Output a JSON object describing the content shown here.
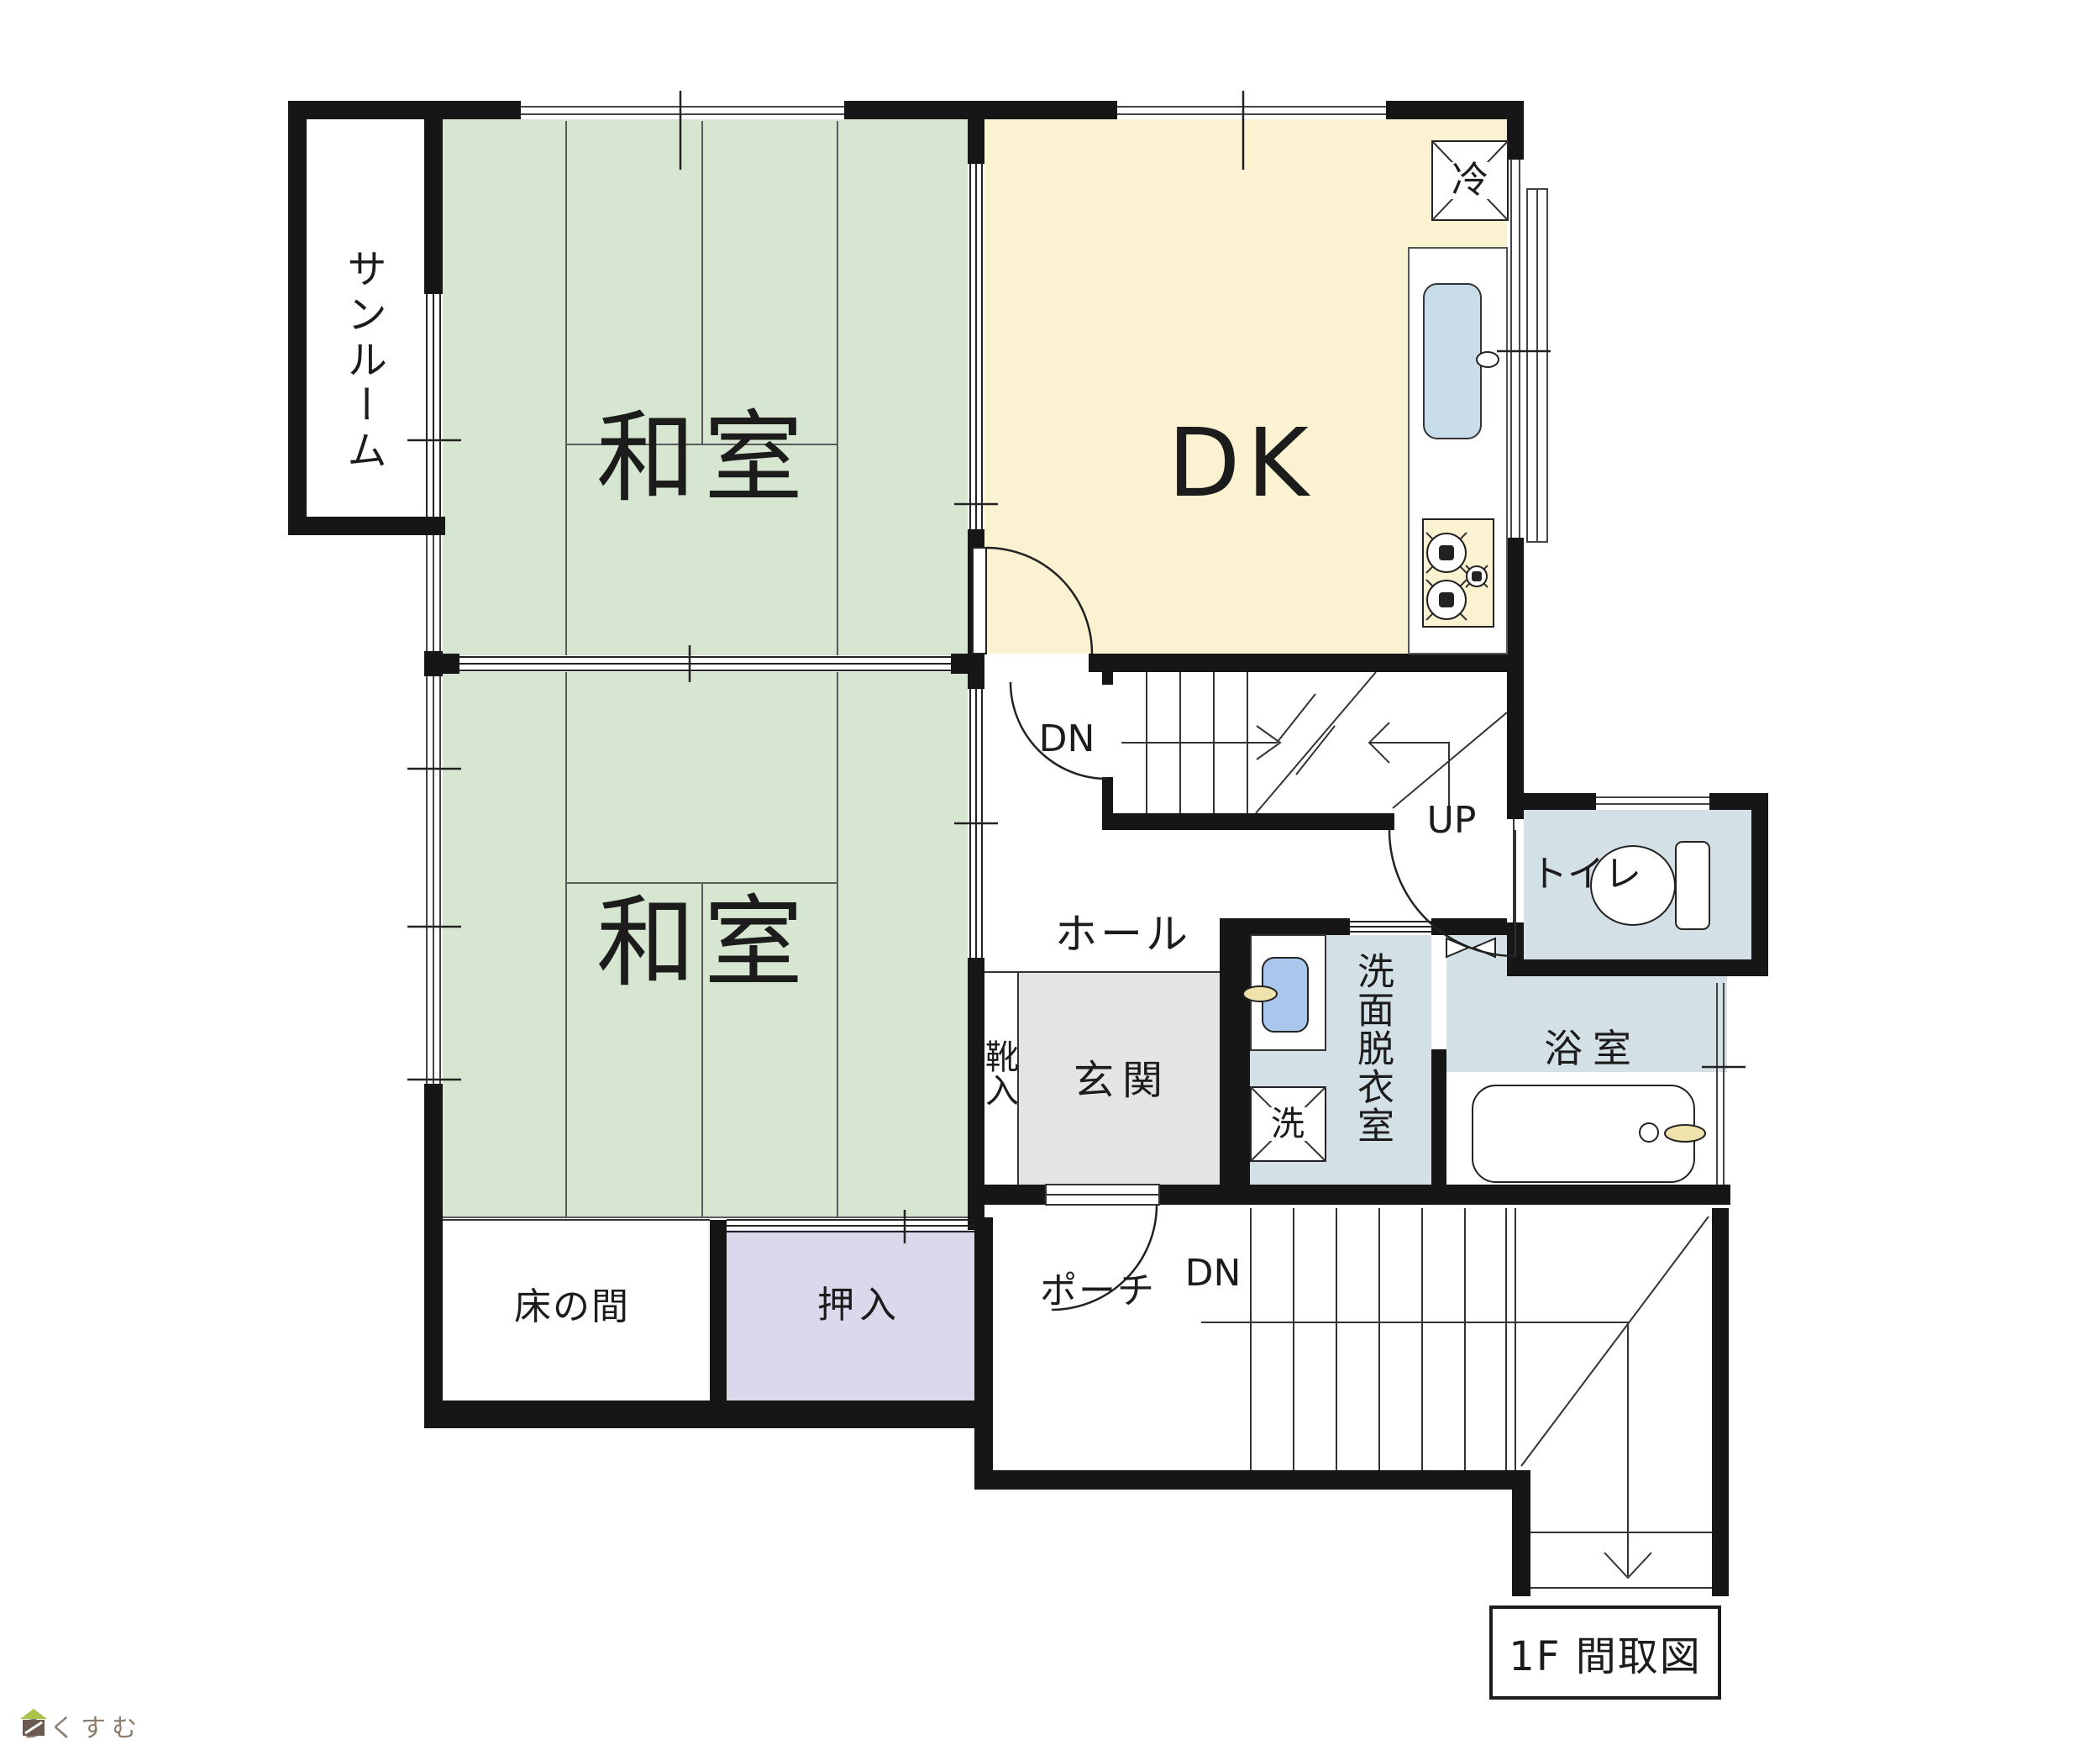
{
  "labels": {
    "sunroom": "サンルーム",
    "washitsu_upper": "和室",
    "washitsu_lower": "和室",
    "dk": "DK",
    "fridge": "冷",
    "hall": "ホール",
    "stairs_dn": "DN",
    "stairs_up": "UP",
    "toilet": "トイレ",
    "bath": "浴室",
    "washroom": "洗面脱衣室",
    "washer": "洗",
    "genkan": "玄関",
    "shoe_cabinet": "靴入",
    "tokonoma": "床の間",
    "oshiire": "押入",
    "porch": "ポーチ",
    "porch_dn": "DN",
    "plan_caption": "1F 間取図",
    "watermark": "らくすむ"
  },
  "colors": {
    "wall": "#161616",
    "green": "#d7e6d0",
    "cream": "#faf2d0",
    "blue": "#d3e0e6",
    "purple": "#ddd7ec",
    "gray": "#e4e4e4",
    "sink": "#a9c7ec",
    "sink2": "#c9dcea",
    "faucet": "#efe3ab",
    "brown": "#8d7b6c"
  }
}
